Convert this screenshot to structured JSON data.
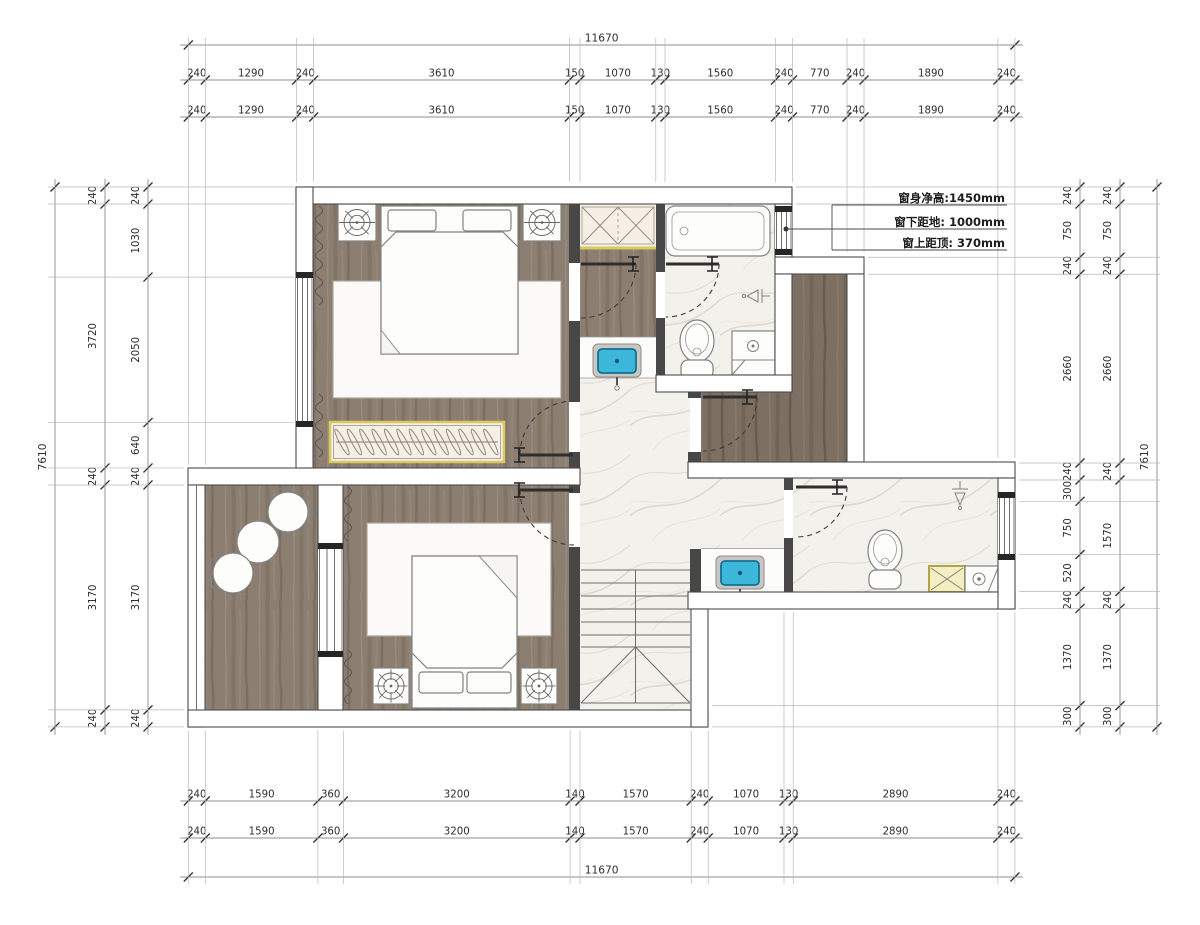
{
  "drawing": {
    "type": "floor-plan",
    "units": "mm"
  },
  "dimensions": {
    "top_total": [
      "11670"
    ],
    "top_row": [
      "240",
      "1290",
      "240",
      "3610",
      "150",
      "1070",
      "130",
      "1560",
      "240",
      "770",
      "240",
      "1890",
      "240"
    ],
    "bottom_row": [
      "240",
      "1590",
      "360",
      "3200",
      "140",
      "1570",
      "240",
      "1070",
      "130",
      "2890",
      "240"
    ],
    "bottom_total": [
      "11670"
    ],
    "left_total": [
      "7610"
    ],
    "left_mid": [
      "240",
      "3720",
      "240",
      "3170",
      "240"
    ],
    "left_inner": [
      "240",
      "1030",
      "2050",
      "640",
      "240",
      "3170",
      "240"
    ],
    "right_total": [
      "7610"
    ],
    "right_mid": [
      "240",
      "750",
      "240",
      "2660",
      "240",
      "1570",
      "240",
      "1370",
      "300"
    ],
    "right_inner": [
      "240",
      "750",
      "240",
      "2660",
      "240",
      "300",
      "750",
      "520",
      "240",
      "1370",
      "300"
    ]
  },
  "annotation": {
    "lines": [
      "窗身净高:1450mm",
      "窗下距地: 1000mm",
      "窗上距顶: 370mm"
    ]
  },
  "colors": {
    "wall_dark": "#474747",
    "wood": "#8c7e70",
    "wood_dark": "#7d7063",
    "marble": "#f3f1ec",
    "marble_vein": "#ddd9d1",
    "cabinet_yellow": "#d9c95c",
    "cabinet_fill": "#f6efe6",
    "sink_cyan": "#3db7d9",
    "sink_cyan_dark": "#156f92"
  }
}
